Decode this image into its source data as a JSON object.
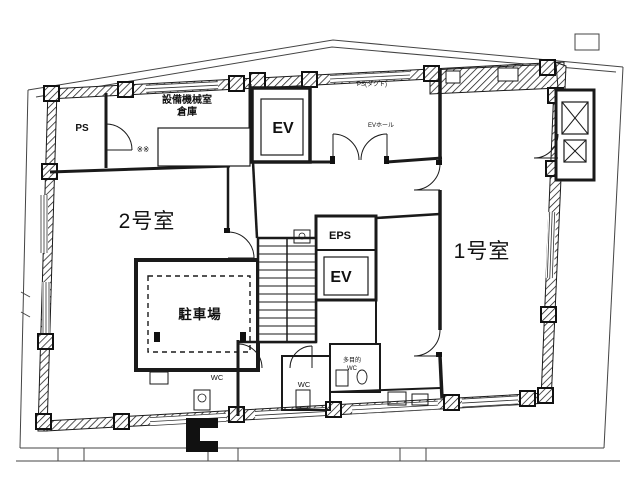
{
  "drawing": {
    "type": "floor-plan",
    "labels": {
      "room2": "2号室",
      "room1": "1号室",
      "parking": "駐車場",
      "equip_line1": "設備機械室",
      "equip_line2": "倉庫",
      "ps": "PS",
      "ev_top": "EV",
      "eps": "EPS",
      "ev_mid": "EV",
      "wc_left": "WC",
      "wc_mid": "WC",
      "wc_multi_line1": "多目的",
      "wc_multi_line2": "WC",
      "ev_hall": "EVホール",
      "duct": "PS(ダクト)",
      "marks": "※※"
    },
    "colors": {
      "line": "#1a1a1a",
      "boundary": "#444444",
      "background": "#ffffff"
    }
  }
}
